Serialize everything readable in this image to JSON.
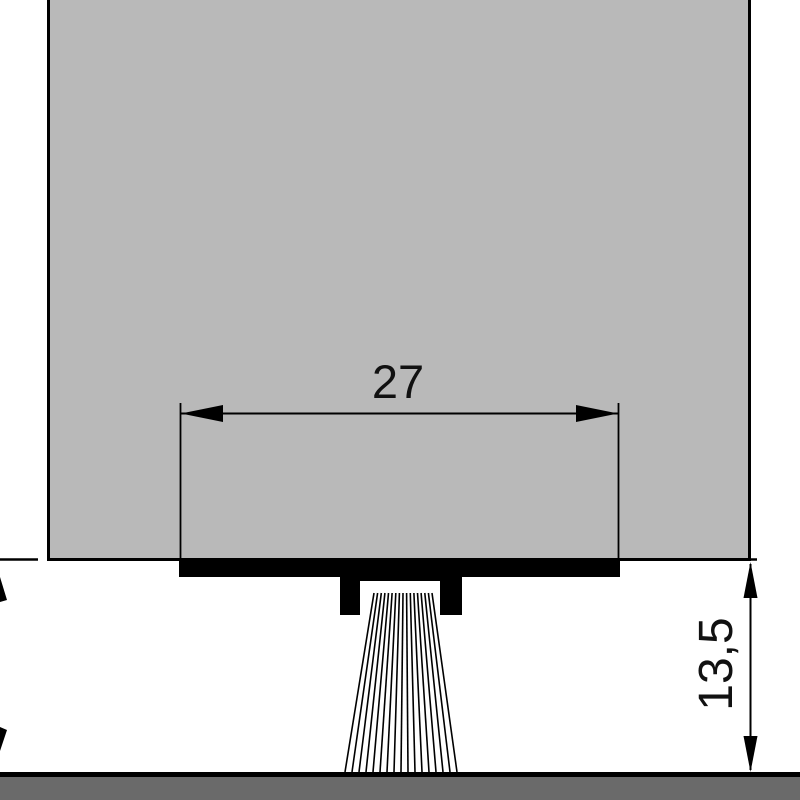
{
  "diagram": {
    "type": "technical-drawing-cross-section",
    "labels": {
      "width_dimension": "27",
      "height_dimension": "13,5"
    },
    "colors": {
      "background": "#ffffff",
      "door_fill": "#b9b9b9",
      "profile_fill": "#000000",
      "line": "#000000",
      "floor_fill": "#6a6a6a"
    }
  }
}
